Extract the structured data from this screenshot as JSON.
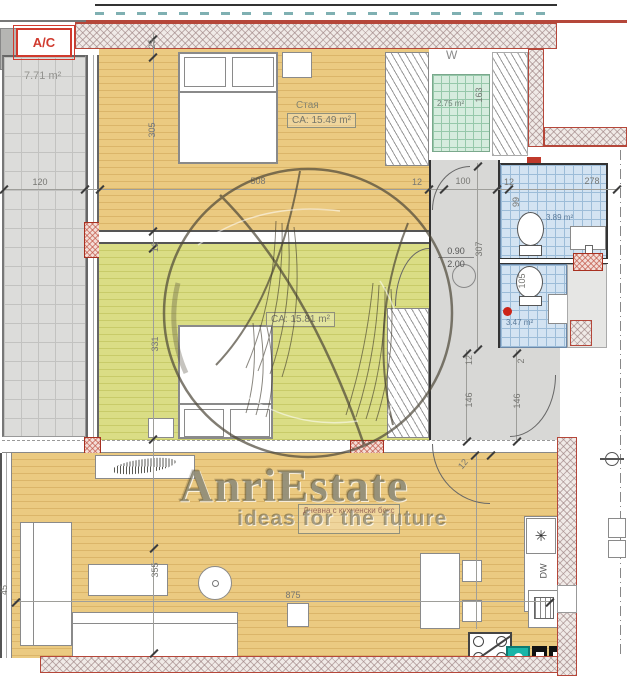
{
  "watermark": {
    "brand": "AnriEstate",
    "tagline": "ideas for the future"
  },
  "badges": {
    "ac": "A/C"
  },
  "rooms": {
    "terrace": {
      "area": "7.71 m²"
    },
    "bedroom1": {
      "name": "Стая",
      "area": "CA: 15.49 m²"
    },
    "bedroom2": {
      "area": "CA: 15.81 m²"
    },
    "closet": {
      "name": "W",
      "area": "2.75 m²"
    },
    "bath1": {
      "area": "3.89 m²"
    },
    "bath2": {
      "area": "3.47 m²"
    },
    "living": {
      "name": "Дневна с кухненски бокс"
    }
  },
  "door_size": {
    "width": "0.90",
    "height": "2.00"
  },
  "appliances": {
    "dishwasher": "DW",
    "fridge": "✳"
  },
  "colors": {
    "wood": "#ebca81",
    "wood_green": "#dadd85",
    "tile_blue": "#d3e3f2",
    "tile_green": "#d6ecde",
    "wall_accent": "#b5473a",
    "sink_teal": "#19b5a8"
  },
  "dimensions": [
    {
      "text": "120",
      "x": 40,
      "y": 182,
      "rot": 0
    },
    {
      "text": "25",
      "x": 152,
      "y": 44,
      "rot": -90
    },
    {
      "text": "305",
      "x": 152,
      "y": 130,
      "rot": -90
    },
    {
      "text": "508",
      "x": 258,
      "y": 181,
      "rot": 0
    },
    {
      "text": "12",
      "x": 417,
      "y": 182,
      "rot": 0
    },
    {
      "text": "100",
      "x": 463,
      "y": 181,
      "rot": 0
    },
    {
      "text": "12",
      "x": 509,
      "y": 182,
      "rot": 0
    },
    {
      "text": "278",
      "x": 592,
      "y": 181,
      "rot": 0
    },
    {
      "text": "163",
      "x": 479,
      "y": 95,
      "rot": -90
    },
    {
      "text": "99",
      "x": 516,
      "y": 202,
      "rot": -90
    },
    {
      "text": "307",
      "x": 479,
      "y": 249,
      "rot": -90
    },
    {
      "text": "105",
      "x": 522,
      "y": 281,
      "rot": -90
    },
    {
      "text": "12",
      "x": 155,
      "y": 247,
      "rot": -90
    },
    {
      "text": "331",
      "x": 155,
      "y": 344,
      "rot": -90
    },
    {
      "text": "12",
      "x": 469,
      "y": 360,
      "rot": -90
    },
    {
      "text": "146",
      "x": 469,
      "y": 400,
      "rot": -90
    },
    {
      "text": "2",
      "x": 521,
      "y": 361,
      "rot": -90
    },
    {
      "text": "146",
      "x": 517,
      "y": 401,
      "rot": -90
    },
    {
      "text": "12",
      "x": 463,
      "y": 464,
      "rot": -50
    },
    {
      "text": "355",
      "x": 155,
      "y": 570,
      "rot": -90
    },
    {
      "text": "875",
      "x": 293,
      "y": 595,
      "rot": 0
    },
    {
      "text": "45",
      "x": 4,
      "y": 590,
      "rot": -90
    }
  ]
}
